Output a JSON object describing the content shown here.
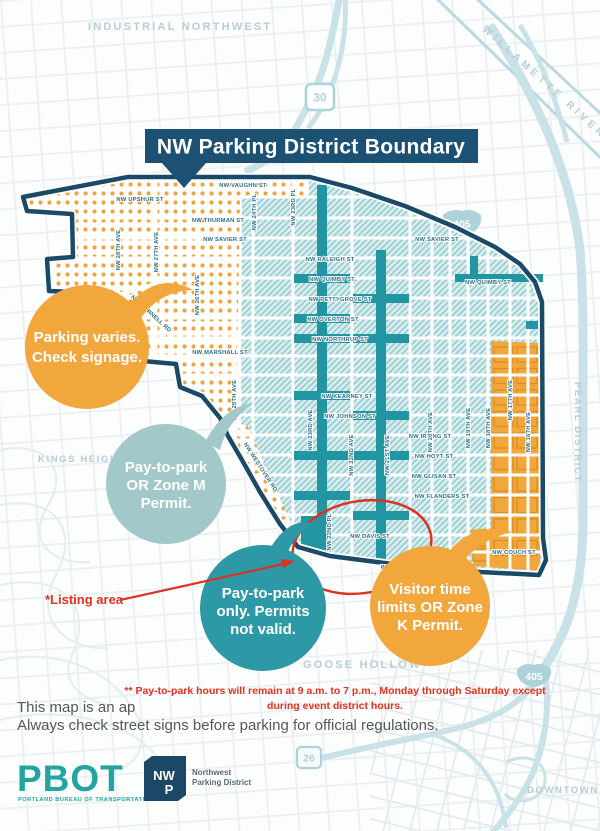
{
  "banner": {
    "title": "NW Parking District Boundary"
  },
  "area_labels": {
    "industrial_northwest": "INDUSTRIAL NORTHWEST",
    "willamette_river": "WILLAMETTE RIVER",
    "kings_heights": "KINGS HEIGHTS",
    "pearl_district": "PEARL DISTRICT",
    "goose_hollow": "GOOSE HOLLOW",
    "downtown": "DOWNTOWN"
  },
  "shields": {
    "us30": "30",
    "i405_top": "405",
    "i405_bottom": "405",
    "us26": "26"
  },
  "streets": {
    "horizontal": [
      "NW VAUGHN ST",
      "NW UPSHUR ST",
      "NW THURMAN ST",
      "NW SAVIER ST",
      "NW SAVIER ST",
      "NW RALEIGH ST",
      "NW QUIMBY ST",
      "NW QUIMBY ST",
      "NW PETTYGROVE ST",
      "NW OVERTON ST",
      "NW NORTHRUP ST",
      "NW MARSHALL ST",
      "NW KEARNEY ST",
      "NW JOHNSON ST",
      "NW IRVING ST",
      "NW HOYT ST",
      "NW GLISAN ST",
      "NW FLANDERS ST",
      "NW DAVIS ST",
      "W BURNSIDE ST",
      "NW COUCH ST"
    ],
    "vertical": [
      "NW 28TH AVE",
      "NW 27TH AVE",
      "NW 26TH AVE",
      "NW 25TH AVE",
      "NW 24TH PL",
      "NW 23RD PL",
      "NW 23RD AVE",
      "NW 22ND AVE",
      "NW 22ND PL",
      "NW 21ST AVE",
      "NW 20TH AVE",
      "NW 19TH AVE",
      "NW 18TH AVE",
      "NW 17TH AVE",
      "NW 16TH AVE"
    ],
    "diagonal": [
      "NW CORNELL RD",
      "NW WESTOVER RD"
    ]
  },
  "callouts": {
    "parking_varies": {
      "lines": [
        "Parking varies.",
        "Check signage."
      ]
    },
    "zone_m": {
      "lines": [
        "Pay-to-park",
        "OR Zone M",
        "Permit."
      ]
    },
    "pay_only": {
      "lines": [
        "Pay-to-park",
        "only. Permits",
        "not valid."
      ]
    },
    "zone_k": {
      "lines": [
        "Visitor time",
        "limits OR Zone",
        "K Permit."
      ]
    }
  },
  "annotations": {
    "listing_area": "*Listing area",
    "pay_hours_line1": "** Pay-to-park hours will remain at 9 a.m. to 7 p.m., Monday through Saturday except",
    "pay_hours_line2": "during event district hours."
  },
  "footer": {
    "note_line1": "This map is an ap",
    "note_line2": "Always check street signs before parking for official regulations.",
    "pbot_logo": "PBOT",
    "pbot_sub": "PORTLAND BUREAU OF TRANSPORTATION",
    "nwp_letters_line1": "NW",
    "nwp_letters_line2": "P",
    "nwp_name_line1": "Northwest",
    "nwp_name_line2": "Parking District"
  },
  "colors": {
    "banner_navy": "#1d5173",
    "boundary_navy": "#1a4a68",
    "corridor_teal": "#2196a2",
    "orange": "#f2a73d",
    "muted_blue_circle": "#a3c8ca",
    "teal_circle": "#2e99a6",
    "red": "#e2311e",
    "hatch_bg": "#d9eded",
    "hatch_line": "#96cbd1"
  }
}
